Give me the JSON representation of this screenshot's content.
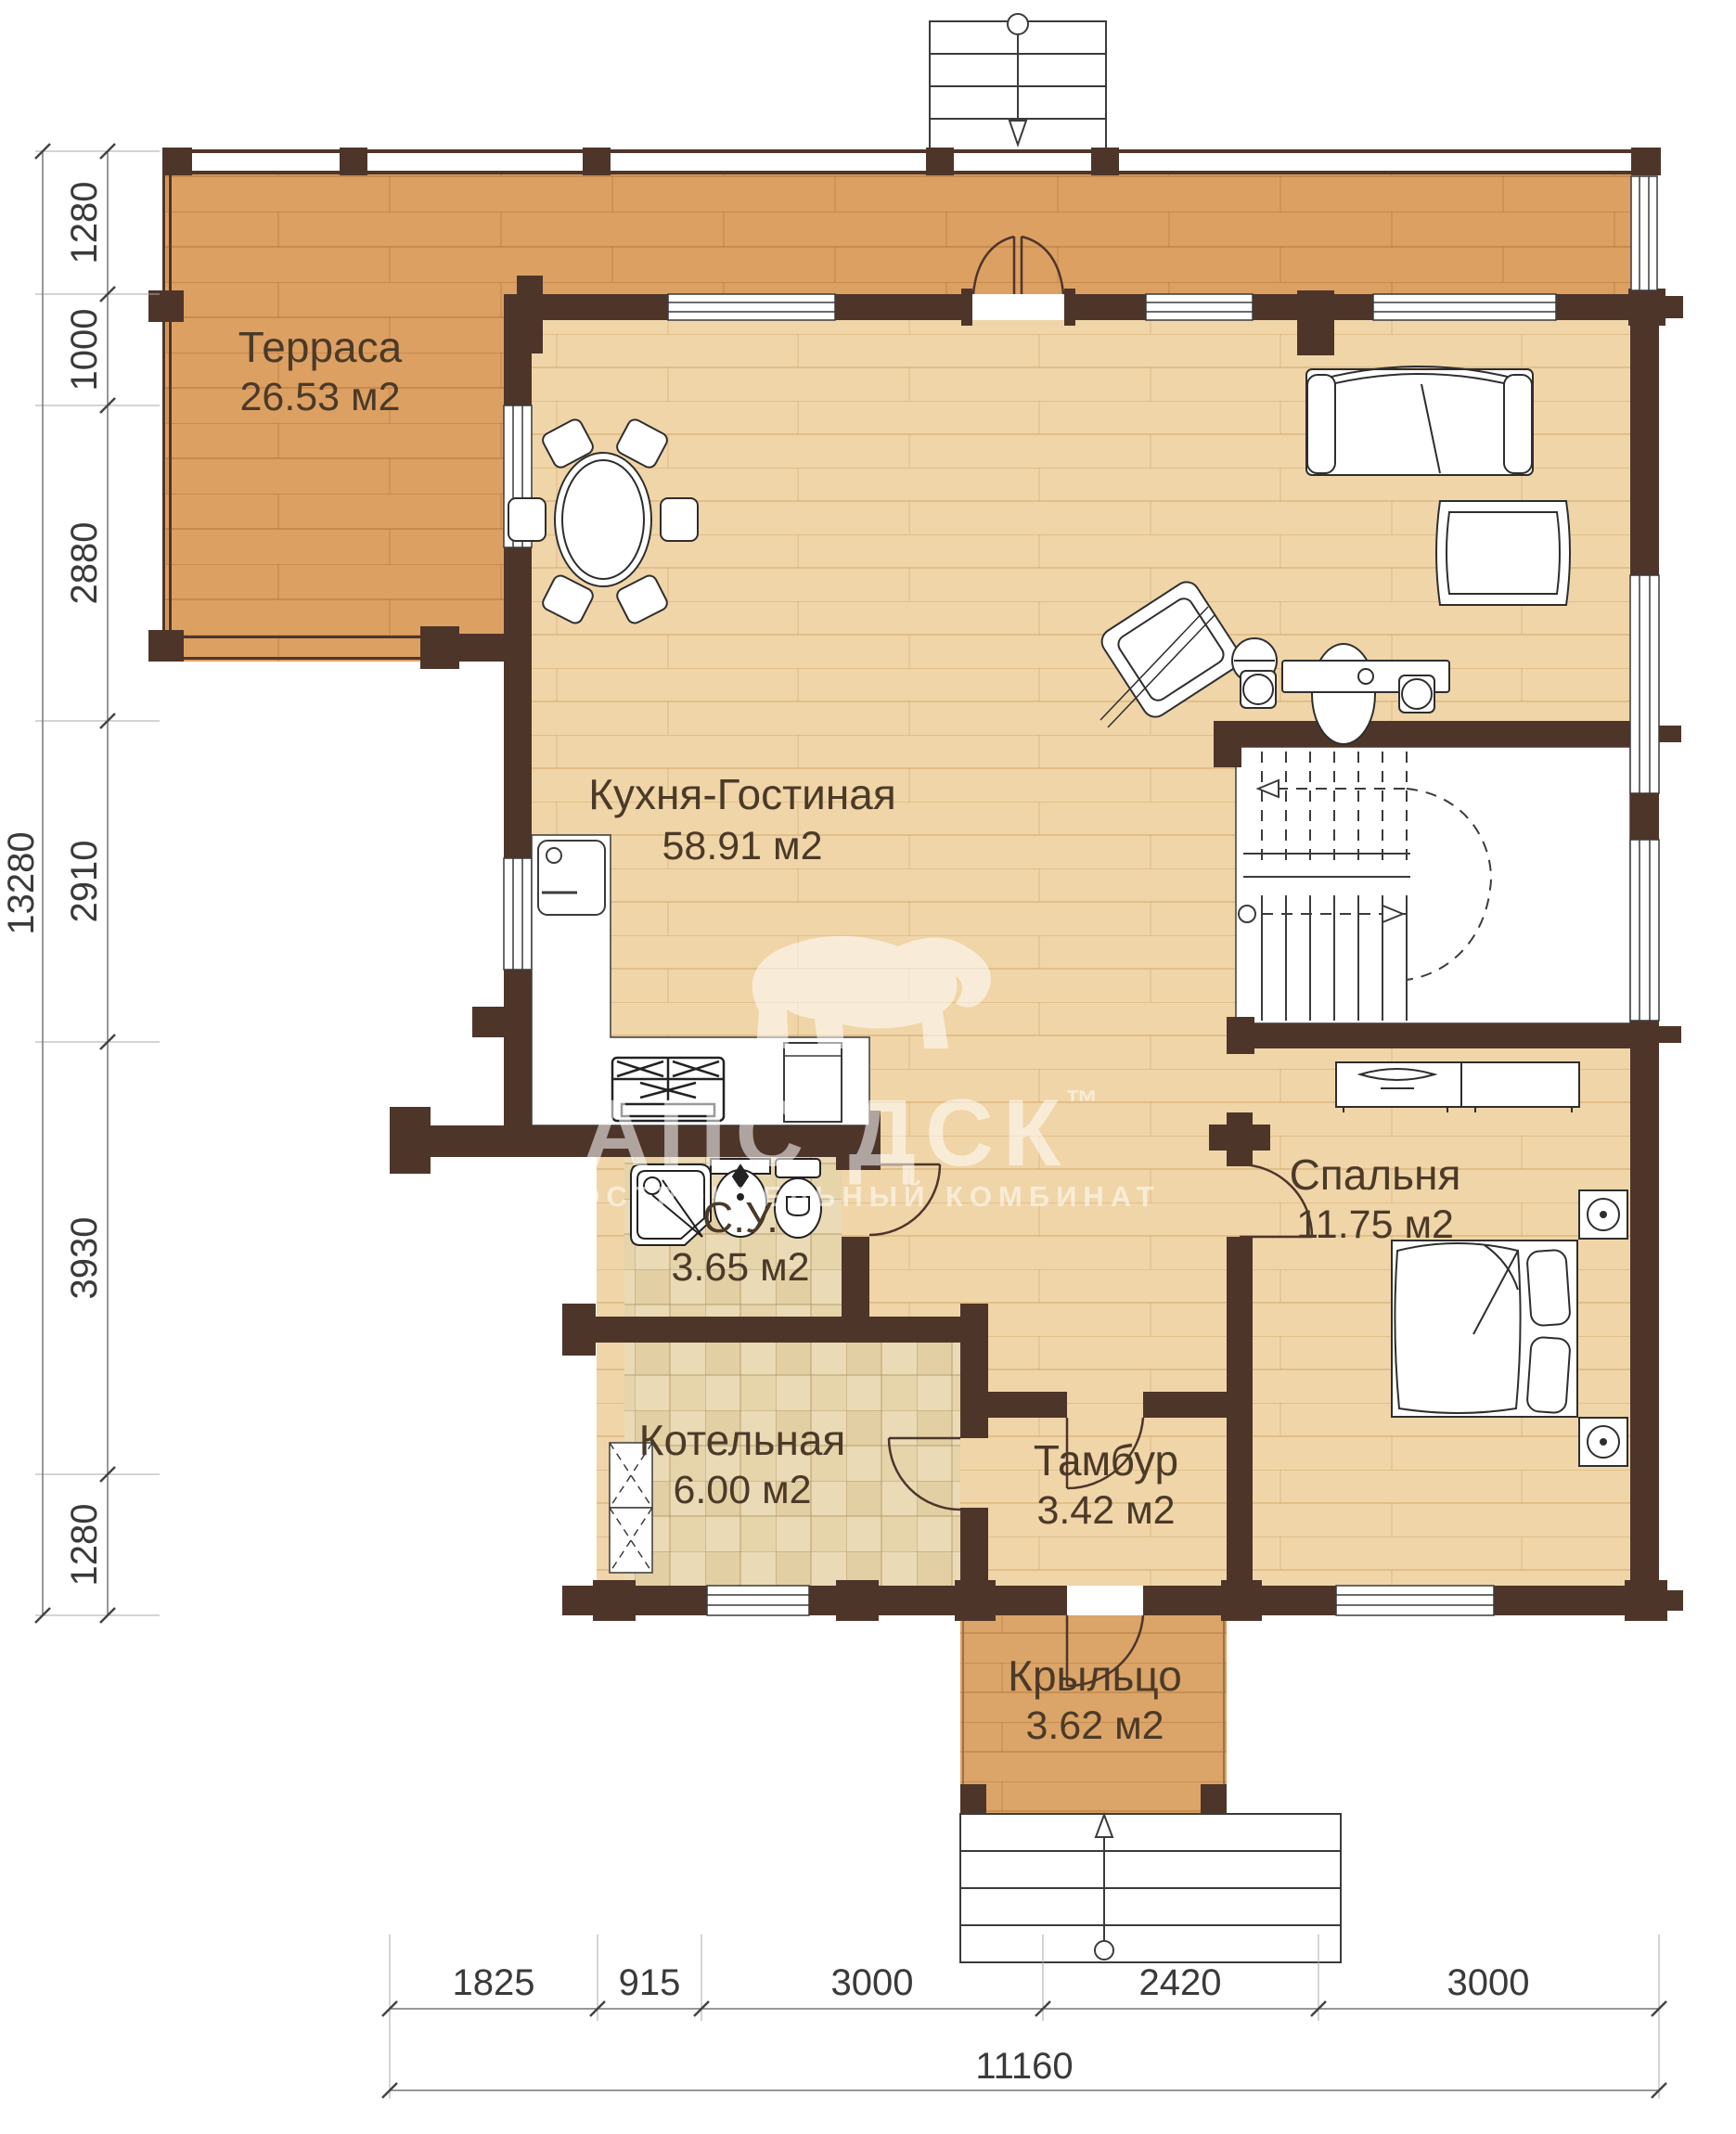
{
  "rooms": [
    {
      "id": "terrace",
      "name": "Терраса",
      "area": "26.53 м2"
    },
    {
      "id": "kitchen-living",
      "name": "Кухня-Гостиная",
      "area": "58.91 м2"
    },
    {
      "id": "bathroom",
      "name": "С.У.",
      "area": "3.65 м2"
    },
    {
      "id": "boiler",
      "name": "Котельная",
      "area": "6.00 м2"
    },
    {
      "id": "vestibule",
      "name": "Тамбур",
      "area": "3.42 м2"
    },
    {
      "id": "bedroom",
      "name": "Спальня",
      "area": "11.75 м2"
    },
    {
      "id": "porch",
      "name": "Крыльцо",
      "area": "3.62 м2"
    }
  ],
  "dimensions": {
    "left": {
      "total": "13280",
      "segments": [
        "1280",
        "1000",
        "2880",
        "2910",
        "3930",
        "1280"
      ]
    },
    "bottom": {
      "total": "11160",
      "segments": [
        "1825",
        "915",
        "3000",
        "2420",
        "3000"
      ]
    }
  },
  "watermark": {
    "brand": "АПС ДСК",
    "tm": "™",
    "subtitle": "ДОМОСТРОИТЕЛЬНЫЙ КОМБИНАТ"
  },
  "colors": {
    "wall": "#4e352a",
    "terrace_floor": "#dca063",
    "house_floor": "#f0d5a8",
    "porch_floor": "#dba468",
    "tile_floor": "#eadab6",
    "outline": "#3b3b3b",
    "label": "#4b3a28",
    "dimension_text": "#3a3a3a"
  }
}
